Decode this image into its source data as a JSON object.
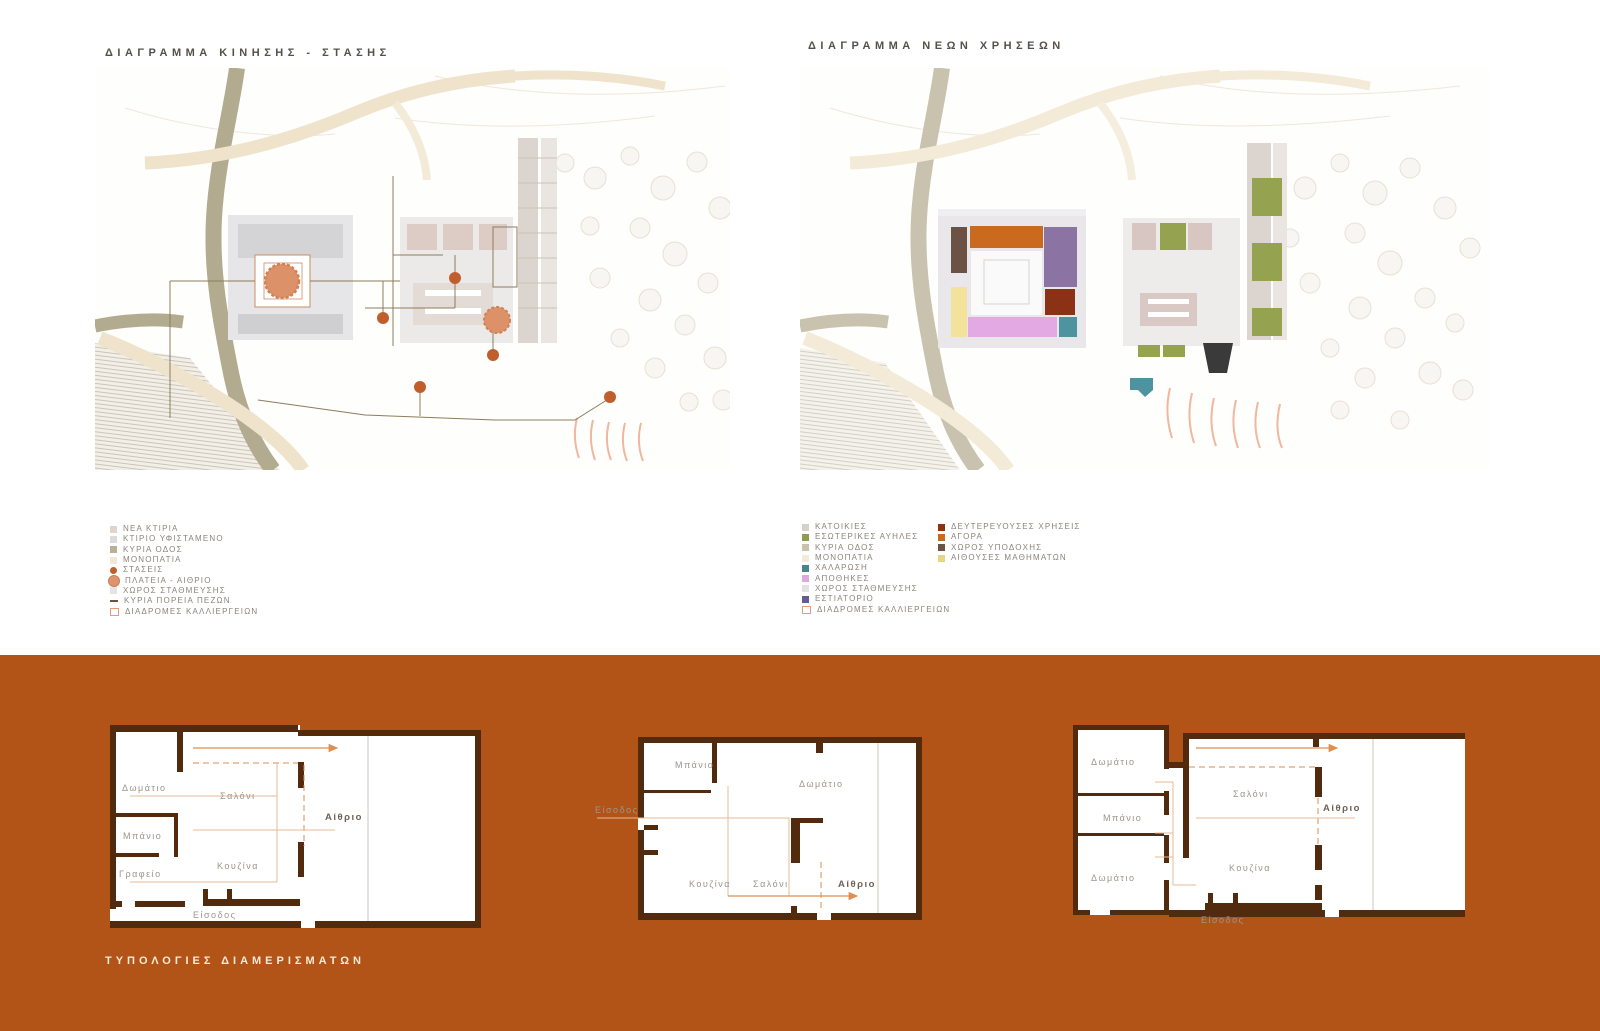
{
  "board": {
    "bg": "#ffffff",
    "band_bg": "#b25417"
  },
  "left_diagram": {
    "title": "ΔΙΑΓΡΑΜΜΑ ΚΙΝΗΣΗΣ - ΣΤΑΣΗΣ",
    "legend": [
      {
        "label": "ΝΕΑ ΚΤΙΡΙΑ",
        "color": "#e0d5cd",
        "type": "square"
      },
      {
        "label": "ΚΤΙΡΙΟ ΥΦΙΣΤΑΜΕΝΟ",
        "color": "#dbdbdb",
        "type": "square"
      },
      {
        "label": "ΚΥΡΙΑ ΟΔΟΣ",
        "color": "#b9b197",
        "type": "square"
      },
      {
        "label": "ΜΟΝΟΠΑΤΙΑ",
        "color": "#f1e7d4",
        "type": "square"
      },
      {
        "label": "ΣΤΑΣΕΙΣ",
        "color": "#c05f2c",
        "type": "dot"
      },
      {
        "label": "ΠΛΑΤΕΙΑ - ΑΙΘΡΙΟ",
        "color": "#dd9271",
        "type": "plaza"
      },
      {
        "label": "ΧΩΡΟΣ ΣΤΑΘΜΕΥΣΗΣ",
        "color": "#e4e4e4",
        "type": "square"
      },
      {
        "label": "ΚΥΡΙΑ ΠΟΡΕΙΑ ΠΕΖΩΝ",
        "color": "#6a5638",
        "type": "line"
      },
      {
        "label": "ΔΙΑΔΡΟΜΕΣ ΚΑΛΛΙΕΡΓΕΙΩΝ",
        "color": "#e59c78",
        "type": "outline"
      }
    ]
  },
  "right_diagram": {
    "title": "ΔΙΑΓΡΑΜΜΑ ΝΕΩΝ ΧΡΗΣΕΩΝ",
    "legend_col1": [
      {
        "label": "ΚΑΤΟΙΚΙΕΣ",
        "color": "#d7d0ca",
        "type": "square"
      },
      {
        "label": "ΕΣΩΤΕΡΙΚΕΣ ΑΥΗΛΕΣ",
        "color": "#8e9c4d",
        "type": "square"
      },
      {
        "label": "ΚΥΡΙΑ ΟΔΟΣ",
        "color": "#c9c1ab",
        "type": "square"
      },
      {
        "label": "ΜΟΝΟΠΑΤΙΑ",
        "color": "#f4ead8",
        "type": "square"
      },
      {
        "label": "ΧΑΛΑΡΩΣΗ",
        "color": "#49858f",
        "type": "square"
      },
      {
        "label": "ΑΠΟΘΗΚΕΣ",
        "color": "#dfa8de",
        "type": "square"
      },
      {
        "label": "ΧΩΡΟΣ ΣΤΑΘΜΕΥΣΗΣ",
        "color": "#e2e2e2",
        "type": "square"
      },
      {
        "label": "ΕΣΤΙΑΤΟΡΙΟ",
        "color": "#665a8f",
        "type": "square"
      },
      {
        "label": "ΔΙΑΔΡΟΜΕΣ ΚΑΛΛΙΕΡΓΕΙΩΝ",
        "color": "#e59c78",
        "type": "outline"
      }
    ],
    "legend_col2": [
      {
        "label": "ΔΕΥΤΕΡΕΥΟΥΣΕΣ ΧΡΗΣΕΙΣ",
        "color": "#8c3315",
        "type": "square"
      },
      {
        "label": "ΑΓΟΡΑ",
        "color": "#c96a1e",
        "type": "square"
      },
      {
        "label": "ΧΩΡΟΣ ΥΠΟΔΟΧΗΣ",
        "color": "#6b5244",
        "type": "square"
      },
      {
        "label": "ΑΙΘΟΥΣΕΣ ΜΑΘΗΜΑΤΩΝ",
        "color": "#e8d584",
        "type": "square"
      }
    ]
  },
  "typologies": {
    "title": "ΤΥΠΟΛΟΓΙΕΣ ΔΙΑΜΕΡΙΣΜΑΤΩΝ",
    "plan_a": {
      "bedroom": "Δωμάτιο",
      "living": "Σαλόνι",
      "bath": "Μπάνιο",
      "office": "Γραφείο",
      "kitchen": "Κουζίνα",
      "entrance": "Είσοδος",
      "atrium": "Αίθριο"
    },
    "plan_b": {
      "bath": "Μπάνιο",
      "bedroom": "Δωμάτιο",
      "entrance": "Είσοδος",
      "kitchen": "Κουζίνα",
      "living": "Σαλόνι",
      "atrium": "Αίθριο"
    },
    "plan_c": {
      "bedroom1": "Δωμάτιο",
      "bath": "Μπάνιο",
      "bedroom2": "Δωμάτιο",
      "living": "Σαλόνι",
      "kitchen": "Κουζίνα",
      "entrance": "Είσοδος",
      "atrium": "Αίθριο"
    }
  },
  "map_colors": {
    "agora": "#c96a1e",
    "estiatorio": "#8b73a4",
    "defterevouses": "#8a3116",
    "ypodochi": "#6b5244",
    "aithouses": "#f2e29b",
    "apothikes": "#e3a9e2",
    "chalarosi": "#4f92a0",
    "avles": "#95a351",
    "plaza": "#dc9169",
    "stop_dot": "#c05f2c"
  }
}
